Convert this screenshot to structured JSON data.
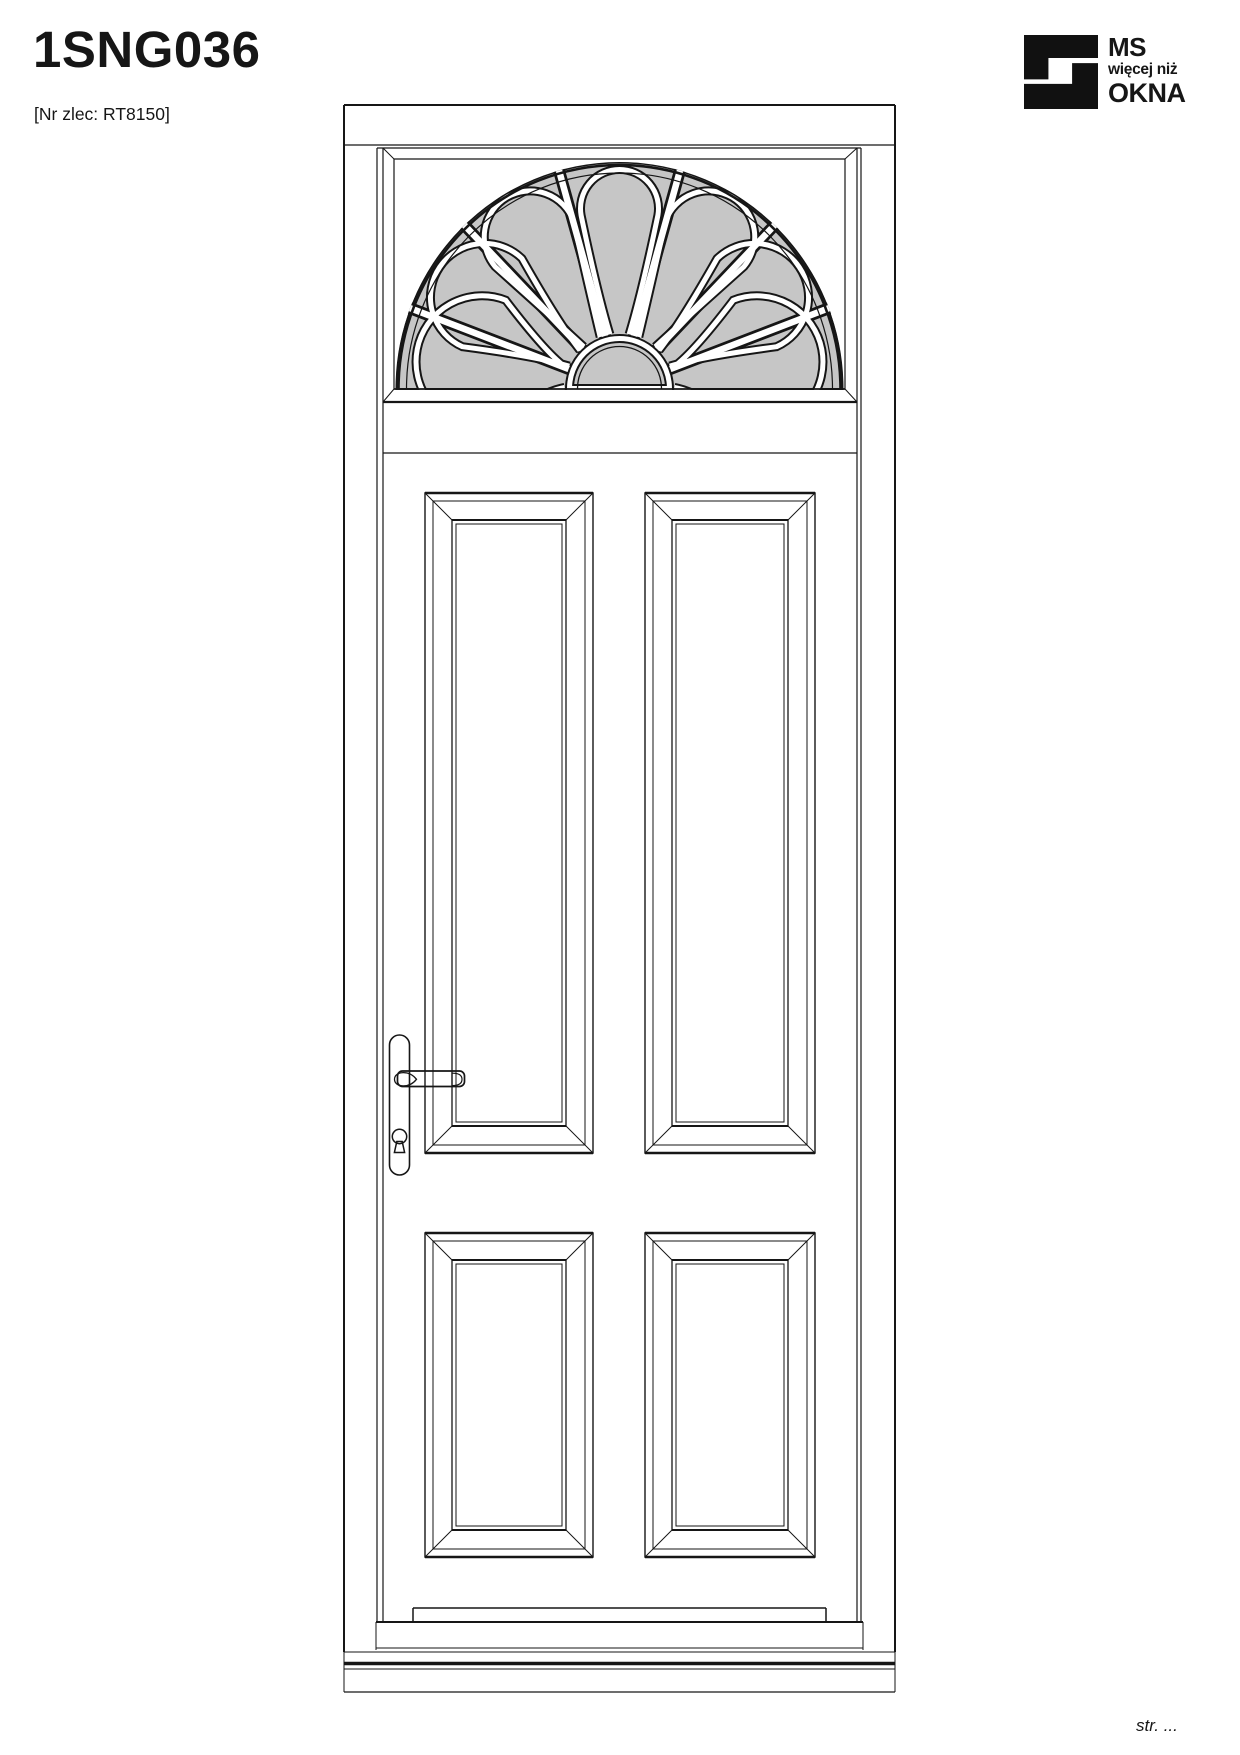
{
  "header": {
    "title": "1SNG036",
    "order_ref": "[Nr zlec: RT8150]"
  },
  "logo": {
    "line1": "MS",
    "line2": "więcej niż",
    "line3": "OKNA"
  },
  "drawing": {
    "label": "Single door elevation with semicircular petal fanlight transom",
    "glass_color": "#c6c6c6",
    "line_color": "#161616"
  },
  "footer": {
    "page_label": "str. ..."
  }
}
